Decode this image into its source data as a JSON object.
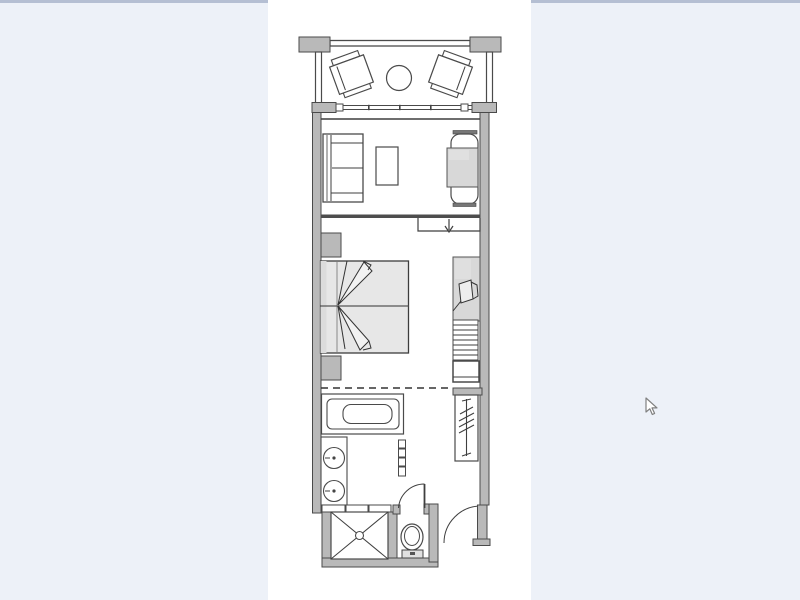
{
  "window": {
    "kind": "image-viewer-showing-floor-plan",
    "has_visible_text": false
  },
  "colors": {
    "background": "#edf1f8",
    "topBorder": "#b5bfd3",
    "canvas": "#ffffff",
    "wall": "#b9b9b9",
    "outline": "#4a4a4a",
    "line": "#3f3f3f",
    "bedFill": "#e7e7e7",
    "shadeFill": "#d8d8d8",
    "lightFill": "#e3e3e3"
  },
  "cursor": {
    "x": 645,
    "y": 397,
    "shape": "arrow-pointer"
  },
  "floorplan": {
    "type": "hotel-guestroom-floor-plan",
    "orientation": "vertical",
    "areas": [
      "balcony",
      "living-area",
      "bedroom",
      "bathroom",
      "water-closet",
      "entry"
    ],
    "fixtures": [
      "balcony-lounge-chair-left",
      "balcony-lounge-chair-right",
      "balcony-table",
      "balcony-railing",
      "sliding-window",
      "sofa",
      "coffee-table",
      "desk-with-chair",
      "room-divider-wall",
      "entry-arrow",
      "bed",
      "bed-throw-fan",
      "nightstand-top",
      "nightstand-bottom",
      "wardrobe",
      "closet-shelves",
      "lower-cabinet",
      "ladder-shelf",
      "privacy-dashed-line",
      "bathtub",
      "vanity-counter",
      "sink-top",
      "sink-bottom",
      "tile-partition",
      "shower-stall",
      "shower-drain",
      "toilet",
      "wc-door-swing",
      "entry-door-swing"
    ]
  }
}
